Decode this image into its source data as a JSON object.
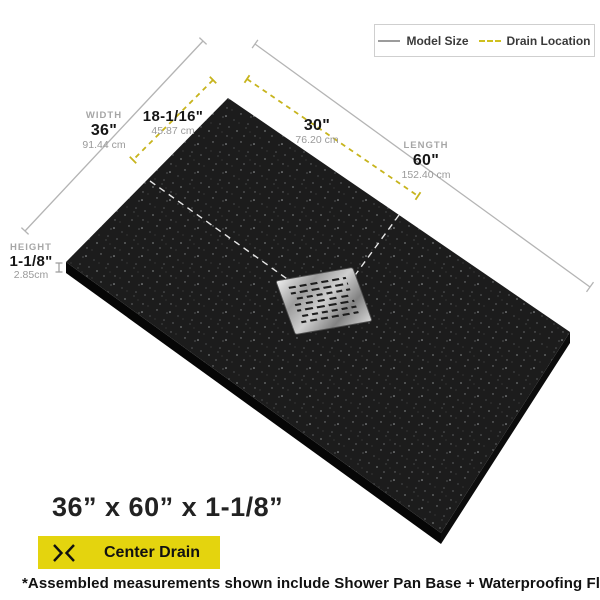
{
  "legend": {
    "model_size": "Model Size",
    "drain_location": "Drain Location"
  },
  "dimensions": {
    "width": {
      "label": "WIDTH",
      "value": "36\"",
      "metric": "91.44 cm"
    },
    "drain_offset_width": {
      "value": "18-1/16\"",
      "metric": "45.87 cm"
    },
    "drain_offset_length": {
      "value": "30\"",
      "metric": "76.20 cm"
    },
    "length": {
      "label": "LENGTH",
      "value": "60\"",
      "metric": "152.40 cm"
    },
    "height": {
      "label": "HEIGHT",
      "value": "1-1/8\"",
      "metric": "2.85cm"
    }
  },
  "footer": {
    "size_title": "36” x 60” x 1-1/8”",
    "drain_badge": "Center Drain",
    "footnote": "*Assembled measurements shown include Shower Pan Base + Waterproofing Flange"
  },
  "colors": {
    "accent_yellow": "#e4d40e",
    "dash_yellow": "#c7b41d",
    "model_line_gray": "#b4b4b4",
    "pan_black": "#1c1c1c",
    "drain_metal": "#b5b5b5"
  }
}
